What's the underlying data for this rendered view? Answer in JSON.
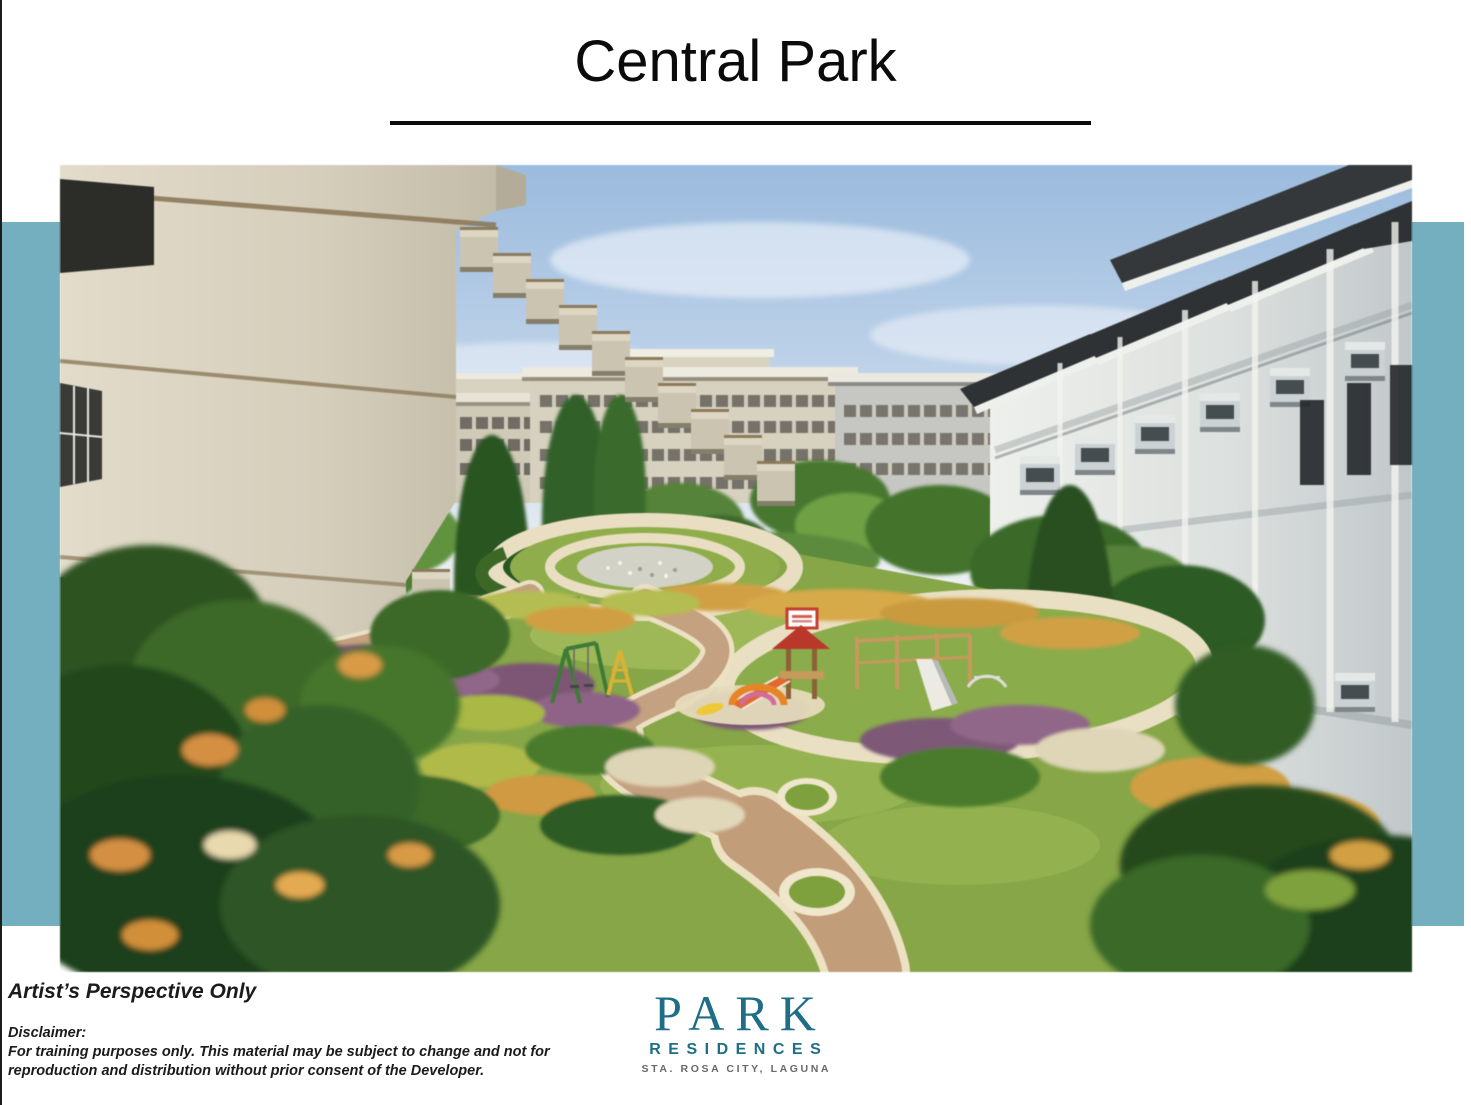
{
  "slide": {
    "title": "Central Park",
    "background": "#ffffff",
    "accent_bar_color": "#74afbf",
    "left_border_color": "#1c1c1c",
    "title_color": "#0b0b0b"
  },
  "image": {
    "alt": "Artist's perspective rendering of the Central Park landscaped courtyard between two mid-rise residential buildings, with winding walkways, gardens, a circular plaza and a children's playground"
  },
  "notes": {
    "artist_note": "Artist’s Perspective Only",
    "disclaimer_label": "Disclaimer:",
    "disclaimer_line1": "For training purposes only. This material may be subject to change and not for",
    "disclaimer_line2": "reproduction and distribution without prior consent of the Developer."
  },
  "logo": {
    "name": "PARK",
    "subname": "RESIDENCES",
    "location": "STA. ROSA CITY, LAGUNA",
    "primary_color": "#1d6e86",
    "location_color": "#696969"
  }
}
